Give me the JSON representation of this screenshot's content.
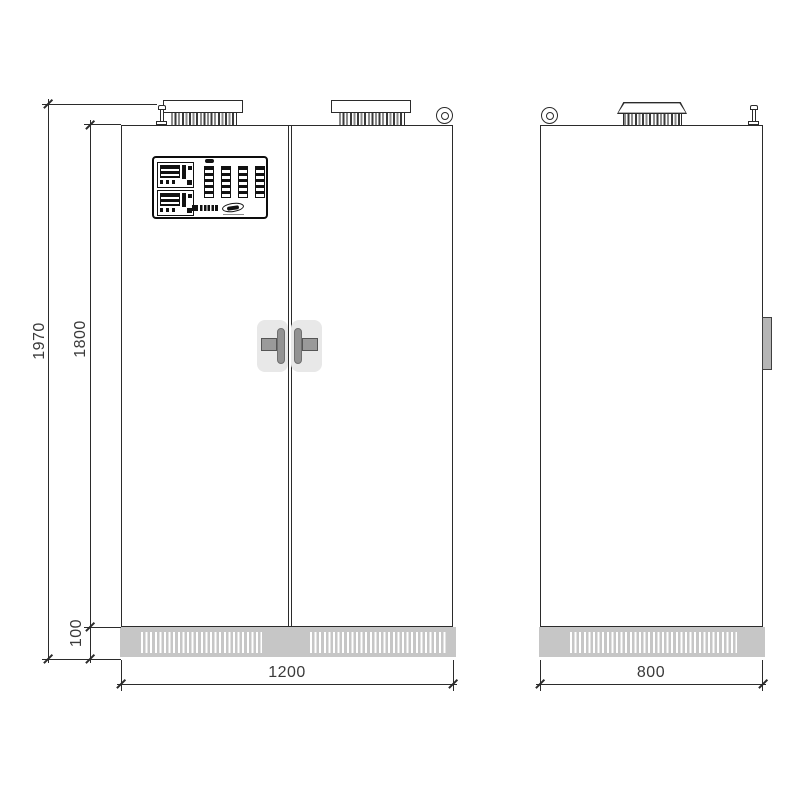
{
  "drawing": {
    "dimensions": {
      "overall_height_mm": "1970",
      "cabinet_height_mm": "1800",
      "plinth_height_mm": "100",
      "front_width_mm": "1200",
      "depth_mm": "800"
    },
    "colors": {
      "line": "#2b2b2b",
      "plinth_gray": "#c6c6c6",
      "handle_plate_gray": "#e8e8e8",
      "handle_grip_gray": "#929292",
      "panel_border": "#0d0d0d",
      "background": "#ffffff"
    },
    "icons": [
      "roof-vent-icon",
      "eyebolt-icon",
      "lifting-eye-icon",
      "door-handle-icon",
      "louver-grille-icon",
      "control-panel-icon",
      "brand-logo-icon"
    ]
  }
}
